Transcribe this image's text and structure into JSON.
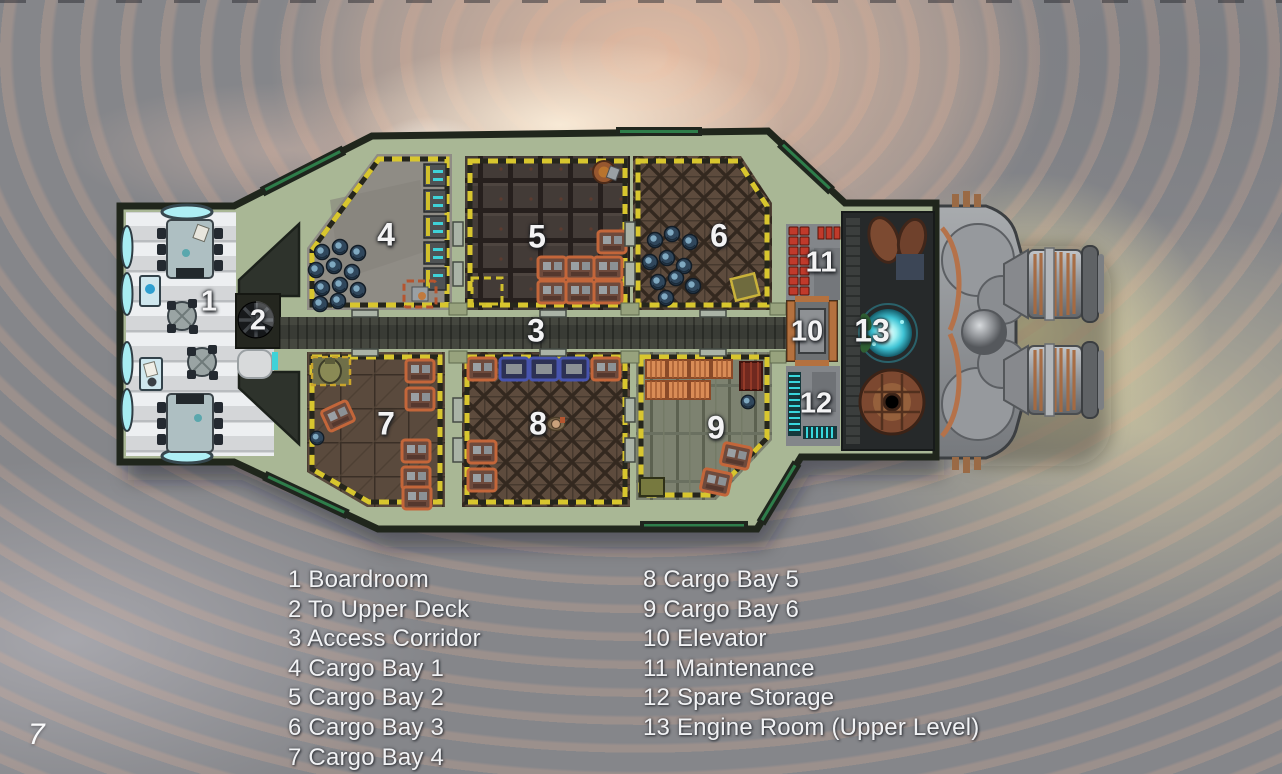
{
  "page_number": "7",
  "legend": {
    "column1": [
      "1 Boardroom",
      "2 To Upper Deck",
      "3 Access Corridor",
      "4 Cargo Bay 1",
      "5 Cargo Bay 2",
      "6 Cargo Bay 3",
      "7 Cargo Bay 4"
    ],
    "column2": [
      "8 Cargo Bay 5",
      "9 Cargo Bay 6",
      "10 Elevator",
      "11 Maintenance",
      "12 Spare Storage",
      "13 Engine Room (Upper Level)"
    ]
  },
  "map": {
    "type": "ship-deck-plan",
    "room_labels": [
      {
        "number": "1",
        "name": "Boardroom",
        "x": 209,
        "y": 302
      },
      {
        "number": "2",
        "name": "To Upper Deck",
        "x": 258,
        "y": 321
      },
      {
        "number": "3",
        "name": "Access Corridor",
        "x": 536,
        "y": 331
      },
      {
        "number": "4",
        "name": "Cargo Bay 1",
        "x": 386,
        "y": 235
      },
      {
        "number": "5",
        "name": "Cargo Bay 2",
        "x": 537,
        "y": 237
      },
      {
        "number": "6",
        "name": "Cargo Bay 3",
        "x": 719,
        "y": 236
      },
      {
        "number": "7",
        "name": "Cargo Bay 4",
        "x": 386,
        "y": 424
      },
      {
        "number": "8",
        "name": "Cargo Bay 5",
        "x": 538,
        "y": 424
      },
      {
        "number": "9",
        "name": "Cargo Bay 6",
        "x": 716,
        "y": 428
      },
      {
        "number": "10",
        "name": "Elevator",
        "x": 807,
        "y": 332
      },
      {
        "number": "11",
        "name": "Maintenance",
        "x": 821,
        "y": 263
      },
      {
        "number": "12",
        "name": "Spare Storage",
        "x": 816,
        "y": 404
      },
      {
        "number": "13",
        "name": "Engine Room (Upper Level)",
        "x": 872,
        "y": 331
      }
    ]
  },
  "colors": {
    "background_grey": "#85868a",
    "nebula_salmon": "#efc3a4",
    "nebula_core": "#fdf6ea",
    "engine_glow": "#e9e0ac",
    "hull_green": "#a9b795",
    "hull_outline": "#20261c",
    "hazard_yellow": "#d8c62e",
    "corridor_grey": "#45473f",
    "concrete_grey": "#8f8c85",
    "cargo_brown": "#433b37",
    "lattice_brown": "#5d4b3d",
    "deck_green": "#7d8270",
    "crate_orange": "#c3663a",
    "crate_blue": "#4754ae",
    "canister_red": "#c03a2b",
    "shelf_cyan": "#38d7dd",
    "elevator_copper": "#b4713f",
    "boardroom_floor": "#d6d8da",
    "glow_cyan": "#7fe3ea",
    "label_text": "#f3f3f4"
  }
}
